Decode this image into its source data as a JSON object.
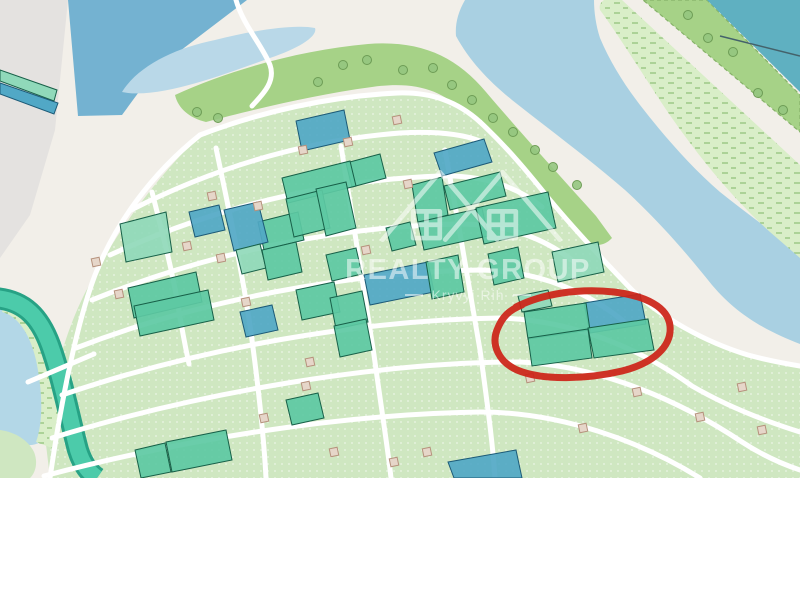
{
  "watermark": {
    "title": "REALTY GROUP",
    "subtitle": "Kryvyi Rih"
  },
  "map": {
    "width": 800,
    "height": 478,
    "colors": {
      "cream": "#f2efe9",
      "gray": "#e4e2e0",
      "water_dark": "#74b2d1",
      "lake": "#b9d8e8",
      "river": "#a9d0e2",
      "teal_water": "#5fb0c1",
      "water_bl": "#b3d7e7",
      "marsh_fill": "#d9eec8",
      "band_green": "#a6d287",
      "band_border": "#86b268",
      "zone_fill": "#cfe7c1",
      "road": "#ffffff",
      "canal_fill": "#4ccbaa",
      "canal_edge": "#27a285",
      "parcel_teal": "#5dc9a3",
      "parcel_mint": "#90d9ba",
      "parcel_blue": "#51a8c6",
      "teal_stroke": "#176048",
      "blue_stroke": "#1c5a77",
      "building": "#e6d6c9",
      "building_stroke": "#b6927d",
      "tree": "#95c57f",
      "tree_stroke": "#6d9c55",
      "annotation_red": "#cc2418",
      "cable": "#44626b"
    },
    "areas": {
      "gray_zone": "M0,0 L68,0 L55,130 L30,215 L0,258 Z",
      "water_top_left": "M68,0 L247,0 L155,70 L122,115 L78,116 Z",
      "lake": "M122,92 C138,66 175,48 215,40 C255,30 295,24 315,28 C318,36 300,48 270,58 C230,72 160,100 122,92 Z",
      "river": "M465,0 C458,12 455,24 456,36 C470,62 490,82 512,100 C550,130 588,158 625,190 C660,222 688,255 712,285 C740,318 770,332 800,344 L800,252 C772,232 745,212 720,192 C692,168 664,136 640,105 C624,84 610,62 600,38 C596,26 594,12 594,0 Z",
      "marsh_ne": "M600,10 C615,30 640,70 665,108 C695,152 730,196 770,232 L800,258 L800,165 L622,0 L604,0 C600,3 599,6 600,10 Z",
      "tree_band_ne": "M643,0 L707,0 L800,95 L800,132 Z",
      "teal_corner": "M707,0 L800,0 L800,92 Z",
      "central_band": "M175,95 C230,70 300,50 368,44 C420,40 456,56 486,92 C520,132 560,176 596,216 L612,238 C601,250 586,246 571,230 C536,194 497,150 463,112 C442,89 412,81 372,87 C312,95 252,110 206,122 C189,118 178,108 175,95 Z",
      "parcel_zone": "M50,478 L44,428 C55,368 70,318 92,280 C115,235 150,185 200,135 C255,112 330,96 400,93 C435,92 460,102 482,122 C508,148 532,176 552,202 C578,232 606,262 634,290 C664,318 706,342 748,356 C766,362 784,366 800,368 L800,478 Z",
      "water_bottom_left": "M0,306 C20,310 35,325 42,350 C50,385 52,415 45,438 C35,450 15,445 0,438 Z",
      "marsh_bottom_left": "M4,304 C30,310 46,330 52,358 C58,392 60,424 52,448 L36,442 C44,420 42,388 36,360 C30,334 18,316 2,312 Z",
      "grass_bottom_left": "M0,430 C15,432 28,440 34,452 C38,462 36,472 30,478 L0,478 Z"
    },
    "strips": [
      {
        "name": "strip-green",
        "type": "mint",
        "pts": "0,70 57,90 54,101 0,81"
      },
      {
        "name": "strip-blue",
        "type": "blue",
        "pts": "0,83 58,103 54,114 0,94"
      }
    ],
    "cable": "M720,36 L800,56",
    "canal": "M-6,298 C25,300 40,318 50,345 C62,378 70,420 78,450 C83,466 90,473 97,478",
    "roads": [
      {
        "name": "top-road",
        "d": "M236,0 C243,25 262,45 270,65 C276,82 262,95 252,106"
      },
      {
        "name": "band-road",
        "d": "M200,135 C260,112 330,96 398,93 C432,92 458,102 480,122"
      },
      {
        "name": "shore-road",
        "d": "M480,122 C508,148 530,175 550,200 C575,230 605,262 632,290 C662,318 705,342 748,355 C770,361 788,364 800,366"
      },
      {
        "name": "nw-road",
        "d": "M200,135 C150,175 115,225 95,275 C78,320 62,395 50,478"
      },
      {
        "name": "row-road-1",
        "d": "M131,210 C220,165 310,140 400,133 C435,131 462,134 480,141"
      },
      {
        "name": "row-road-2",
        "d": "M110,255 C220,205 330,180 440,176 C482,175 516,186 542,207"
      },
      {
        "name": "row-road-3",
        "d": "M92,300 C210,252 340,226 460,224 C512,224 552,241 584,270"
      },
      {
        "name": "row-road-4",
        "d": "M76,348 C200,300 350,272 480,270 C542,271 592,294 628,325"
      },
      {
        "name": "row-road-5",
        "d": "M62,395 C200,348 360,320 500,318 C572,320 640,348 692,386 C730,408 768,422 800,432"
      },
      {
        "name": "row-road-6",
        "d": "M52,438 C200,392 380,362 520,362 C602,366 682,402 742,442 C762,455 782,464 800,470"
      },
      {
        "name": "row-road-7",
        "d": "M44,476 C180,440 340,414 480,412 C562,412 642,442 700,478"
      },
      {
        "name": "cross-road-0",
        "d": "M152,192 C163,235 172,270 178,305 C182,330 186,350 189,364"
      },
      {
        "name": "cross-road-1",
        "d": "M216,148 C230,215 244,280 252,340 C260,400 264,440 266,478"
      },
      {
        "name": "cross-road-2",
        "d": "M341,146 C352,215 364,290 374,355 C383,420 388,450 391,478"
      },
      {
        "name": "cross-road-3",
        "d": "M445,150 C457,215 470,290 480,350 C489,415 493,448 495,478"
      },
      {
        "name": "canal-crossing",
        "d": "M28,382 L94,354"
      }
    ],
    "parcels": [
      {
        "type": "blue",
        "pts": "296,121 344,110 350,140 302,151"
      },
      {
        "type": "blue",
        "pts": "434,153 484,139 492,162 442,176"
      },
      {
        "type": "teal",
        "pts": "346,163 380,154 386,178 352,187"
      },
      {
        "type": "teal",
        "pts": "282,178 350,161 356,186 288,203"
      },
      {
        "type": "teal",
        "pts": "258,222 298,212 304,240 264,250"
      },
      {
        "type": "blue",
        "pts": "224,210 258,202 268,242 234,251"
      },
      {
        "type": "blue",
        "pts": "189,212 219,205 225,230 195,237"
      },
      {
        "type": "teal",
        "pts": "286,199 322,190 330,228 294,237"
      },
      {
        "type": "teal",
        "pts": "316,189 346,182 356,228 326,236"
      },
      {
        "type": "mint",
        "pts": "120,224 166,212 172,252 126,262"
      },
      {
        "type": "teal",
        "pts": "412,185 442,177 448,215 418,223"
      },
      {
        "type": "teal",
        "pts": "444,186 500,172 506,196 450,210"
      },
      {
        "type": "teal",
        "pts": "418,222 482,208 488,236 424,250"
      },
      {
        "type": "teal",
        "pts": "476,208 548,192 556,228 484,244"
      },
      {
        "type": "teal",
        "pts": "386,228 410,222 416,245 392,251"
      },
      {
        "type": "teal",
        "pts": "128,288 196,272 202,302 134,318"
      },
      {
        "type": "mint",
        "pts": "236,250 260,244 266,268 242,274"
      },
      {
        "type": "teal",
        "pts": "262,250 296,242 302,272 268,280"
      },
      {
        "type": "teal",
        "pts": "326,255 356,248 362,274 332,281"
      },
      {
        "type": "blue",
        "pts": "364,275 428,262 434,292 370,305"
      },
      {
        "type": "teal",
        "pts": "426,262 458,255 464,292 432,299"
      },
      {
        "type": "teal",
        "pts": "488,254 518,247 524,278 494,285"
      },
      {
        "type": "mint",
        "pts": "552,252 598,242 604,272 558,282"
      },
      {
        "type": "teal",
        "pts": "134,306 208,290 214,320 140,336"
      },
      {
        "type": "blue",
        "pts": "240,312 272,305 278,330 246,337"
      },
      {
        "type": "teal",
        "pts": "296,290 334,282 340,312 302,320"
      },
      {
        "type": "teal",
        "pts": "330,298 362,291 368,322 336,329"
      },
      {
        "type": "teal",
        "pts": "334,326 366,319 372,350 340,357"
      },
      {
        "type": "teal",
        "pts": "286,400 318,393 324,418 292,425"
      },
      {
        "type": "teal",
        "pts": "135,450 165,443 171,472 141,478"
      },
      {
        "type": "teal",
        "pts": "166,442 226,430 232,460 172,472"
      },
      {
        "type": "blue",
        "pts": "448,462 516,450 522,478 454,478"
      },
      {
        "type": "mint",
        "pts": "518,296 548,290 552,306 522,312"
      },
      {
        "type": "blue",
        "pts": "584,303 640,294 646,324 590,333"
      },
      {
        "type": "teal",
        "pts": "524,312 586,303 590,330 528,339"
      },
      {
        "type": "teal",
        "pts": "528,338 588,329 592,358 532,366"
      },
      {
        "type": "teal",
        "pts": "588,328 648,319 654,350 594,358"
      }
    ],
    "buildings": [
      [
        303,
        150
      ],
      [
        348,
        142
      ],
      [
        397,
        120
      ],
      [
        408,
        184
      ],
      [
        212,
        196
      ],
      [
        258,
        206
      ],
      [
        187,
        246
      ],
      [
        221,
        258
      ],
      [
        246,
        302
      ],
      [
        366,
        250
      ],
      [
        310,
        362
      ],
      [
        306,
        386
      ],
      [
        264,
        418
      ],
      [
        334,
        452
      ],
      [
        394,
        462
      ],
      [
        427,
        452
      ],
      [
        530,
        378
      ],
      [
        583,
        428
      ],
      [
        637,
        392
      ],
      [
        700,
        417
      ],
      [
        742,
        387
      ],
      [
        762,
        430
      ],
      [
        96,
        262
      ],
      [
        119,
        294
      ]
    ],
    "trees": [
      [
        197,
        112
      ],
      [
        218,
        118
      ],
      [
        318,
        82
      ],
      [
        343,
        65
      ],
      [
        367,
        60
      ],
      [
        403,
        70
      ],
      [
        433,
        68
      ],
      [
        452,
        85
      ],
      [
        472,
        100
      ],
      [
        493,
        118
      ],
      [
        513,
        132
      ],
      [
        535,
        150
      ],
      [
        553,
        167
      ],
      [
        577,
        185
      ],
      [
        688,
        15
      ],
      [
        708,
        38
      ],
      [
        733,
        52
      ],
      [
        758,
        93
      ],
      [
        783,
        110
      ]
    ],
    "annotation": {
      "d": "M516,307 C542,294 578,288 614,292 C646,296 668,307 670,326 C672,346 654,363 622,371 C588,379 543,381 517,370 C499,362 491,345 497,330 C502,317 509,310 522,305",
      "color": "#cc2418",
      "width": 7
    }
  }
}
